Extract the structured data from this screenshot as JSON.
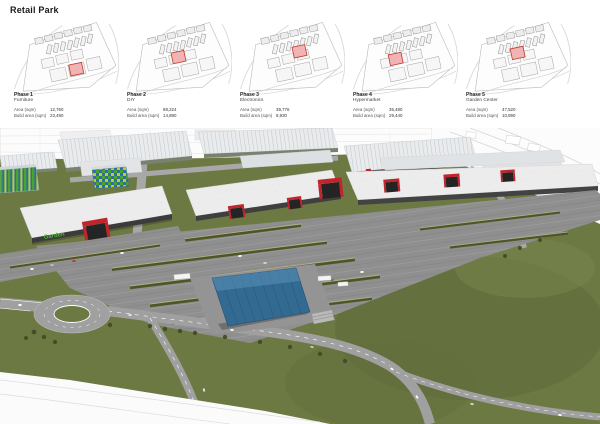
{
  "title": "Retail Park",
  "labels": {
    "area": "Area (sqm)",
    "build": "Build area (sqm)"
  },
  "phases": [
    {
      "name": "Phase 1",
      "category": "Furniture",
      "area": "12,760",
      "build": "23,490",
      "highlight": {
        "x": 4,
        "y": 4
      }
    },
    {
      "name": "Phase 2",
      "category": "DIY",
      "area": "88,224",
      "build": "14,890",
      "highlight": {
        "x": -4,
        "y": -10
      }
    },
    {
      "name": "Phase 3",
      "category": "Electronics",
      "area": "39,776",
      "build": "8,930",
      "highlight": {
        "x": 5,
        "y": -14
      }
    },
    {
      "name": "Phase 4",
      "category": "Hypermarket",
      "area": "35,480",
      "build": "29,440",
      "highlight": {
        "x": -13,
        "y": -10
      }
    },
    {
      "name": "Phase 5",
      "category": "Garden Center",
      "area": "47,520",
      "build": "10,890",
      "highlight": {
        "x": -3,
        "y": -14
      }
    }
  ],
  "render": {
    "store_sign": "Garden",
    "colors": {
      "grass": "#6d7943",
      "road": "#a0a0a0",
      "parking": "#8f8f8f",
      "roof": "#ececec",
      "accent_red": "#c2242b",
      "canopy_blue": "#336a92",
      "sign_green": "#4db837",
      "sketch_line": "#d6d6d6"
    }
  }
}
